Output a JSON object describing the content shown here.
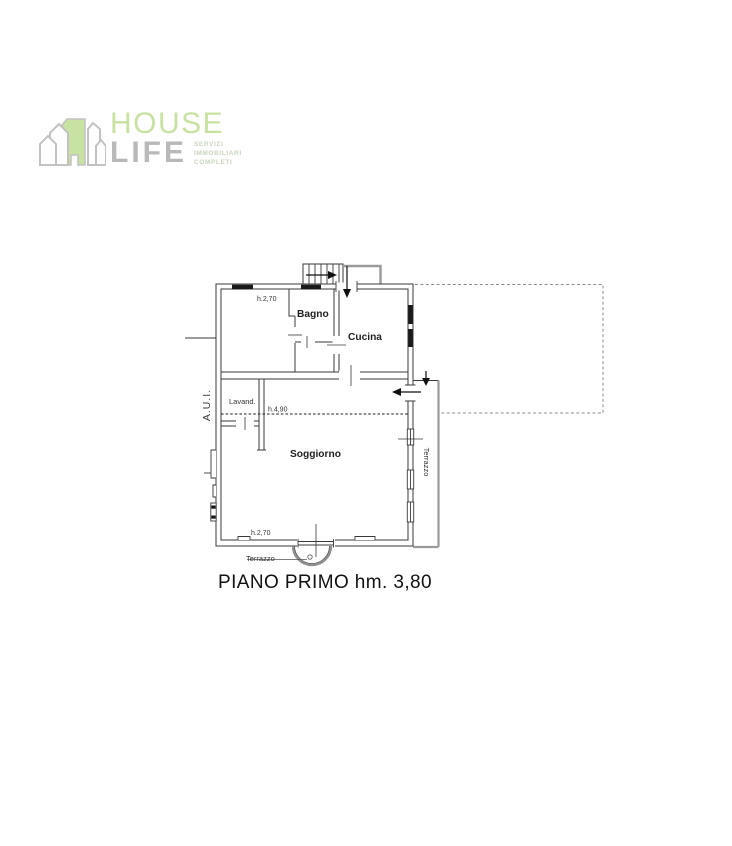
{
  "logo": {
    "name_top": "HOUSE",
    "name_bottom": "LIFE",
    "tagline": [
      "SERVIZI",
      "IMMOBILIARI",
      "COMPLETI"
    ],
    "colors": {
      "green": "#c8e2a2",
      "gray": "#b9b9b9"
    }
  },
  "floor_plan": {
    "rooms": {
      "bagno": "Bagno",
      "cucina": "Cucina",
      "lavanderia": "Lavand.",
      "soggiorno": "Soggiorno"
    },
    "labels": {
      "height_top": "h.2,70",
      "height_mid": "h.4,90",
      "height_bottom": "h.2,70",
      "aui": "A.U.I.",
      "terrazzo_side": "Terrazzo",
      "terrazzo_front": "Terrazzo"
    },
    "line_colors": {
      "ink": "#3a3a3a",
      "gray": "#9a9a9a"
    }
  },
  "caption": "PIANO PRIMO hm. 3,80"
}
